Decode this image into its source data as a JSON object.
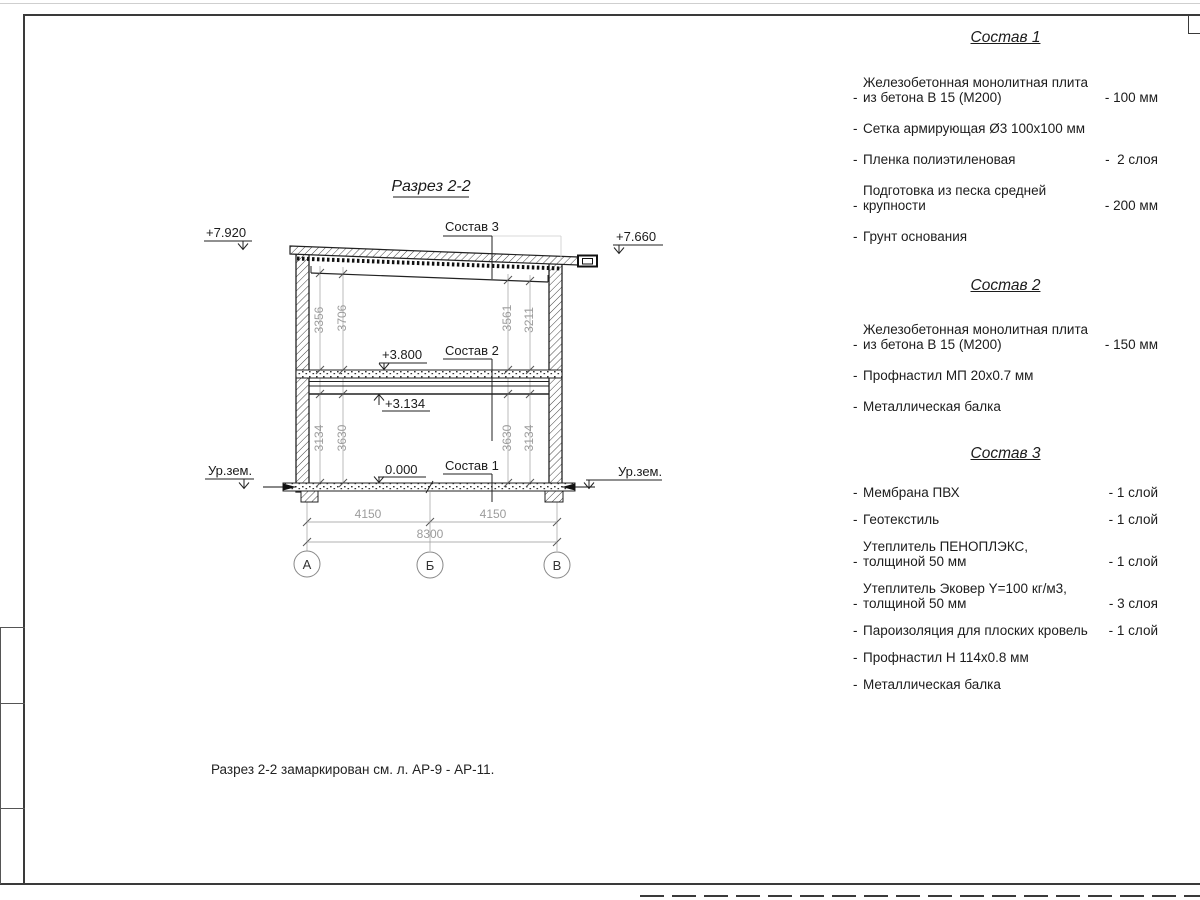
{
  "sheet": {
    "title": "Разрез 2-2",
    "note": "Разрез 2-2 замаркирован см. л. АР-9 - АР-11.",
    "bullet": "-",
    "line_color": "#222222",
    "dim_color": "#9c9c9c"
  },
  "drawing": {
    "levels": {
      "roof_left": "+7.920",
      "roof_right": "+7.660",
      "floor2_top": "+3.800",
      "floor2_beam": "+3.134",
      "floor1": "0.000",
      "ground_left": "Ур.зем.",
      "ground_right": "Ур.зем."
    },
    "layer_refs": {
      "sostav1": "Состав 1",
      "sostav2": "Состав 2",
      "sostav3": "Состав 3"
    },
    "vertical_dims": {
      "upper_left_inner": "3356",
      "upper_left_outer": "3706",
      "upper_right_inner": "3561",
      "upper_right_outer": "3211",
      "lower_left_inner": "3134",
      "lower_left_outer": "3630",
      "lower_right_inner": "3630",
      "lower_right_outer": "3134"
    },
    "horizontal_dims": {
      "span_left": "4150",
      "span_right": "4150",
      "total": "8300"
    },
    "axes": {
      "a": "А",
      "b": "Б",
      "v": "В"
    }
  },
  "compositions": [
    {
      "title": "Состав 1",
      "items": [
        {
          "text": "Железобетонная  монолитная плита\nиз бетона В 15 (М200)",
          "value": "- 100 мм"
        },
        {
          "text": "Сетка армирующая Ø3 100х100 мм",
          "value": ""
        },
        {
          "text": "Пленка полиэтиленовая",
          "value": "-  2 слоя"
        },
        {
          "text": "Подготовка из песка средней\nкрупности",
          "value": "- 200 мм"
        },
        {
          "text": "Грунт основания",
          "value": ""
        }
      ]
    },
    {
      "title": "Состав 2",
      "items": [
        {
          "text": "Железобетонная  монолитная плита\nиз бетона В 15 (М200)",
          "value": "- 150 мм"
        },
        {
          "text": "Профнастил МП 20х0.7 мм",
          "value": ""
        },
        {
          "text": "Металлическая балка",
          "value": ""
        }
      ]
    },
    {
      "title": "Состав 3",
      "items": [
        {
          "text": "Мембрана ПВХ",
          "value": "- 1 слой"
        },
        {
          "text": "Геотекстиль",
          "value": "- 1 слой"
        },
        {
          "text": "Утеплитель ПЕНОПЛЭКС,\nтолщиной 50 мм",
          "value": "- 1 слой"
        },
        {
          "text": "Утеплитель Эковер Y=100 кг/м3,\nтолщиной 50 мм",
          "value": "- 3 слоя"
        },
        {
          "text": "Пароизоляция для плоских кровель",
          "value": "- 1 слой"
        },
        {
          "text": "Профнастил Н 114х0.8 мм",
          "value": ""
        },
        {
          "text": "Металлическая балка",
          "value": ""
        }
      ]
    }
  ]
}
